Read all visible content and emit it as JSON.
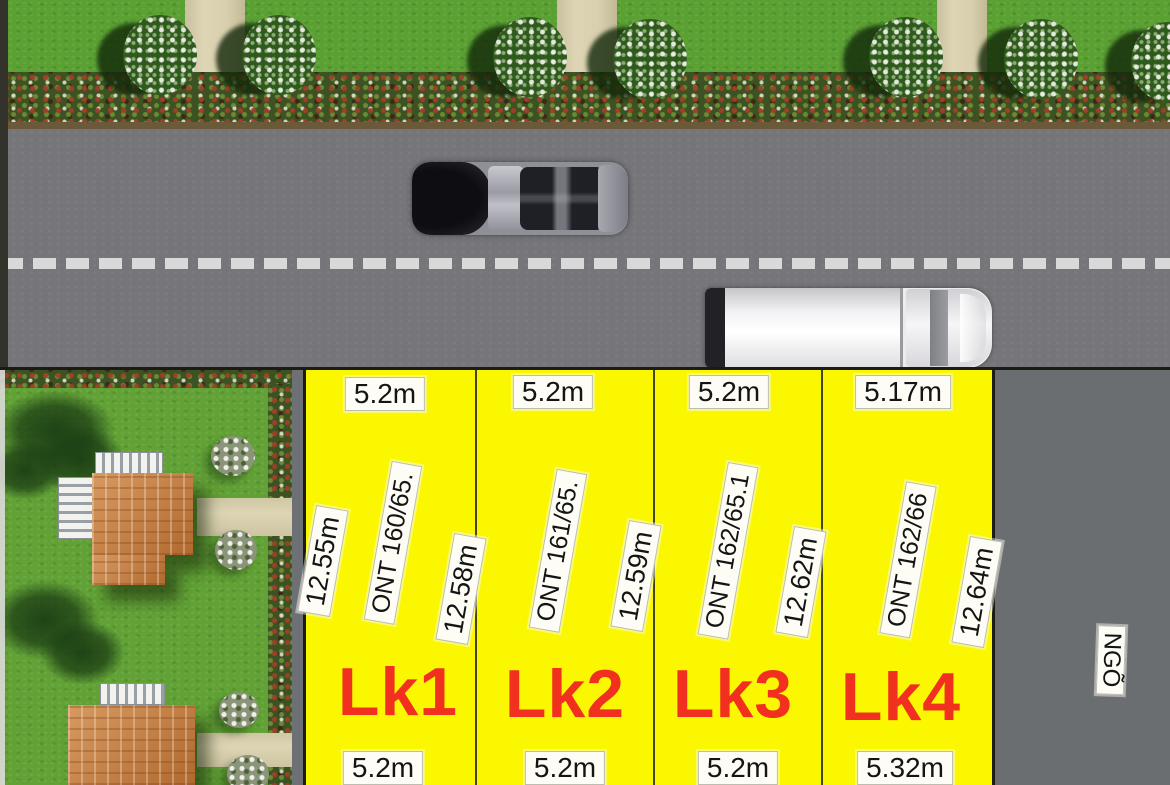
{
  "colors": {
    "plot_fill": "#FAF700",
    "plot_name_red": "#F1301F",
    "road_gray": "#76767A",
    "alley_gray": "#6B6E71",
    "grass_green": "#5AA032",
    "garden_green": "#61A135",
    "roof_orange": "#C9813F",
    "walkway_beige": "#D8CFAE",
    "label_bg": "#FDFDF6",
    "label_text": "#141414",
    "center_line": "#D9D9D9"
  },
  "plots": [
    {
      "name": "Lk1",
      "parcel_id": "ONT 160/65.",
      "width_top": "5.2m",
      "width_bottom": "5.2m",
      "depth_right": "12.58m",
      "depth_left": "12.55m"
    },
    {
      "name": "Lk2",
      "parcel_id": "ONT 161/65.",
      "width_top": "5.2m",
      "width_bottom": "5.2m",
      "depth_right": "12.59m"
    },
    {
      "name": "Lk3",
      "parcel_id": "ONT 162/65.1",
      "width_top": "5.2m",
      "width_bottom": "5.2m",
      "depth_right": "12.62m"
    },
    {
      "name": "Lk4",
      "parcel_id": "ONT 162/66",
      "width_top": "5.17m",
      "width_bottom": "5.32m",
      "depth_right": "12.64m"
    }
  ],
  "alley": {
    "label": "NGÕ"
  }
}
